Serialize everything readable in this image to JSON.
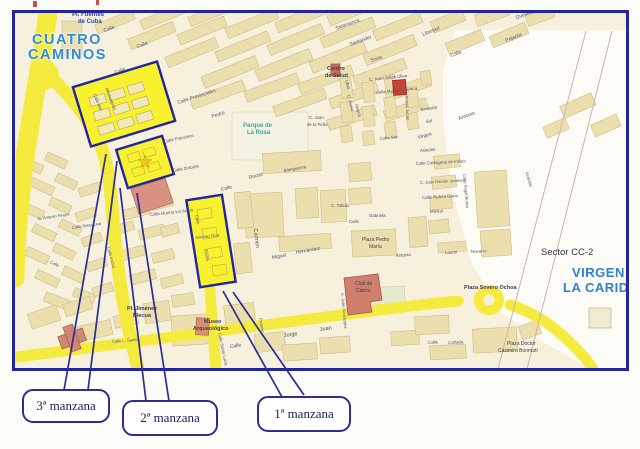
{
  "colors": {
    "map_border": "#23259c",
    "highlight_yellow": "#f8f22e",
    "road_yellow": "#f5eb3e",
    "city_label_blue": "#2f8ad2",
    "building_red": "#c94232",
    "block_khaki": "#ecdfae",
    "callout_navy": "#2a2f90"
  },
  "labels": [
    {
      "text": "CUATRO"
    },
    {
      "text": "CAMINOS"
    },
    {
      "text": "Pl. Fuentes"
    },
    {
      "text": "de Cuba"
    },
    {
      "text": "VIRGEN"
    },
    {
      "text": "LA CARIDAD"
    },
    {
      "text": "Sector CC-2"
    },
    {
      "text": "Parque de"
    },
    {
      "text": "La Rosa"
    },
    {
      "text": "Centro"
    },
    {
      "text": "de Salud"
    },
    {
      "text": "Museo"
    },
    {
      "text": "Arqueológico"
    },
    {
      "text": "Pl. Jiménez"
    },
    {
      "text": "Blecua"
    },
    {
      "text": "Plaza Pedro"
    },
    {
      "text": "María"
    },
    {
      "text": "Club de"
    },
    {
      "text": "Cabos"
    },
    {
      "text": "Plaza Severo Ochoa"
    },
    {
      "text": "Plaza Doctor"
    },
    {
      "text": "Casimiro Bonmatí"
    },
    {
      "text": "Calle"
    },
    {
      "text": "Calle"
    },
    {
      "text": "Pontevedra"
    },
    {
      "text": "Salamanca"
    },
    {
      "text": "Santander"
    },
    {
      "text": "Soria"
    },
    {
      "text": "Calle Provinciales"
    },
    {
      "text": "Pedro"
    },
    {
      "text": "Calle"
    },
    {
      "text": "Monteagudo"
    },
    {
      "text": "Calle Mar"
    },
    {
      "text": "Calle Francisco"
    },
    {
      "text": "Calle Dolores"
    },
    {
      "text": "Calle Huerto los Arcos"
    },
    {
      "text": "Libertad"
    },
    {
      "text": "Quevedo"
    },
    {
      "text": "Pajarita"
    },
    {
      "text": "Calle"
    },
    {
      "text": "Antonio"
    },
    {
      "text": "Virgen"
    },
    {
      "text": "C. Juan Julián Oliva"
    },
    {
      "text": "Calle Manuel Cuenca"
    },
    {
      "text": "Tomasita"
    },
    {
      "text": "Sol"
    },
    {
      "text": "Calle Sta."
    },
    {
      "text": "Ulloa"
    },
    {
      "text": "C. Juana"
    },
    {
      "text": "Alegría"
    },
    {
      "text": "C. Juan"
    },
    {
      "text": "de la Peña"
    },
    {
      "text": "Teresa Jornet"
    },
    {
      "text": "Acacias"
    },
    {
      "text": "Calle Cartagena de Indias"
    },
    {
      "text": "C. Juan Ramón Jiménez"
    },
    {
      "text": "Calle Rubén Darío"
    },
    {
      "text": "Mistral"
    },
    {
      "text": "Laurel"
    },
    {
      "text": "Navarro"
    },
    {
      "text": "Calle Ángel Bruna"
    },
    {
      "text": "Acacias"
    },
    {
      "text": "Doctor"
    },
    {
      "text": "Blanquerna"
    },
    {
      "text": "Calle"
    },
    {
      "text": "Carmen"
    },
    {
      "text": "Miguel"
    },
    {
      "text": "Hernández"
    },
    {
      "text": "C. Toledo"
    },
    {
      "text": "Gabriela"
    },
    {
      "text": "Calle"
    },
    {
      "text": "Antonio"
    },
    {
      "text": "Jorge"
    },
    {
      "text": "Juan"
    },
    {
      "text": "Calle"
    },
    {
      "text": "C. Juan Fernández"
    },
    {
      "text": "Picasso"
    },
    {
      "text": "Calle Santa Lucía"
    },
    {
      "text": "Calle L. Santos"
    },
    {
      "text": "Calle Ancha"
    },
    {
      "text": "Calle Solas Leal"
    },
    {
      "text": "C. Antonio Reyes"
    },
    {
      "text": "Calle"
    },
    {
      "text": "Calle"
    },
    {
      "text": "Cañada"
    },
    {
      "text": "Calle"
    },
    {
      "text": "Jiménez Díaz"
    },
    {
      "text": "Encina"
    }
  ],
  "callouts": [
    {
      "label": "3ª manzana"
    },
    {
      "label": "2ª manzana"
    },
    {
      "label": "1ª manzana"
    }
  ]
}
